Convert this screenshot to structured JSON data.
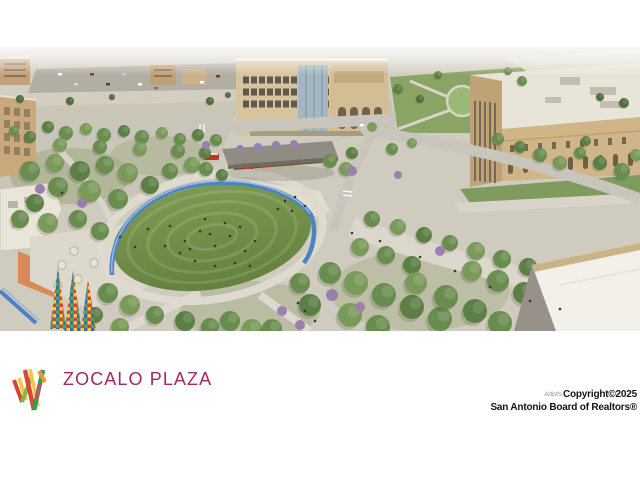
{
  "page": {
    "background_color": "#ffffff"
  },
  "listing_photo": {
    "kind": "aerial architectural rendering",
    "scene": "Zocalo Plaza park: central oval lawn with blue ribbon walkway, tree-lined paseos, festival pavilion, cafe plaza with mosaic sail sculptures, surrounded by tan civic buildings and streets",
    "palette": {
      "lawn_green": "#6f8c49",
      "tree_green": "#6a8c4f",
      "bloom_purple": "#9b7fae",
      "ribbon_blue": "#4d82c4",
      "paving": "#d9d4c9",
      "building_tan": "#cdb387",
      "roof_white": "#f1efe8"
    }
  },
  "branding": {
    "logo_text": "ZOCALO PLAZA",
    "text_color": "#A22965",
    "logo_mark_colors": [
      "#D8432F",
      "#F0962F",
      "#F5C93F",
      "#7CB94E",
      "#2F9E53",
      "#C84F6A"
    ]
  },
  "copyright": {
    "artist_note": "Artist's",
    "line1": "Copyright©2025",
    "line2": "San Antonio Board of Realtors®"
  }
}
